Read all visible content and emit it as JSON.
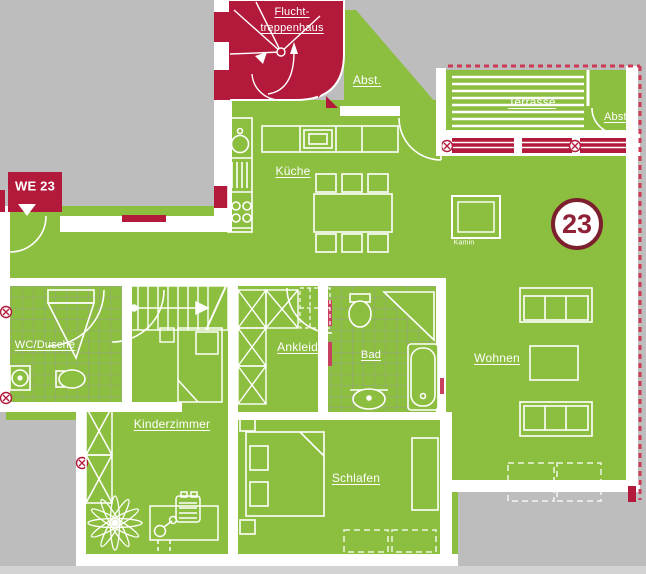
{
  "unit": {
    "number": "23",
    "entrance": "WE 23"
  },
  "rooms": {
    "stairwell_line1": "Flucht-",
    "stairwell_line2": "treppenhaus",
    "storage_upper": "Abst.",
    "terrace": "Terrasse",
    "storage_terrace": "Abst.",
    "kitchen": "Küche",
    "fireplace": "Kamin",
    "wc_shower": "WC/Dusche",
    "dressing": "Ankleide",
    "bathroom": "Bad",
    "living": "Wohnen",
    "childrens_room": "Kinderzimmer",
    "bedroom": "Schlafen"
  },
  "colors": {
    "floor_green": "#8CBE3F",
    "accent_red": "#B2193A",
    "badge_maroon": "#7C202E",
    "outside_gray": "#BDBDBD",
    "wall_white": "#FFFFFF",
    "boundary_dashed_red": "#CC3A57"
  }
}
